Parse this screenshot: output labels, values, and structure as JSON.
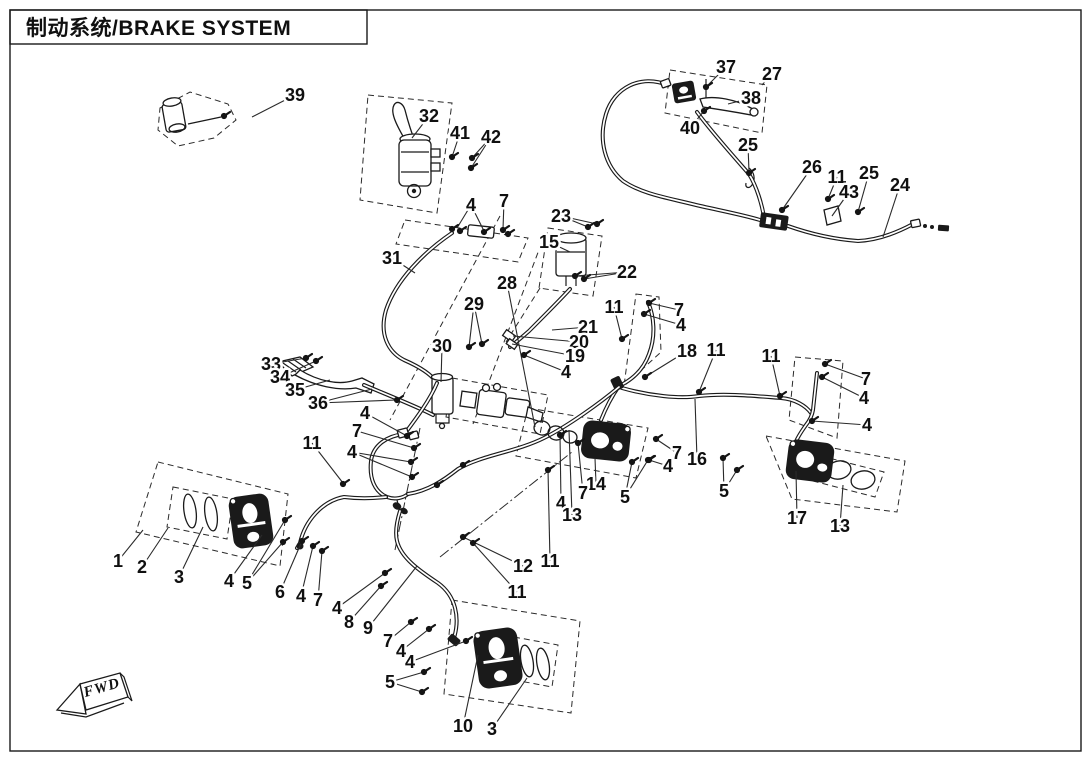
{
  "page": {
    "title": "制动系统/BRAKE SYSTEM",
    "fwd_label": "FWD",
    "colors": {
      "ink": "#1a1a1a",
      "paper": "#ffffff"
    }
  },
  "diagram": {
    "callouts": [
      {
        "n": "39",
        "x": 295,
        "y": 95,
        "t": [
          [
            252,
            117
          ]
        ]
      },
      {
        "n": "37",
        "x": 726,
        "y": 67,
        "t": [
          [
            706,
            87
          ]
        ]
      },
      {
        "n": "27",
        "x": 772,
        "y": 74,
        "t": [
          [
            762,
            85
          ]
        ]
      },
      {
        "n": "38",
        "x": 751,
        "y": 98,
        "t": [
          [
            728,
            104
          ]
        ]
      },
      {
        "n": "40",
        "x": 690,
        "y": 128,
        "t": [
          [
            704,
            111
          ]
        ]
      },
      {
        "n": "25",
        "x": 748,
        "y": 145,
        "t": [
          [
            749,
            172
          ]
        ]
      },
      {
        "n": "26",
        "x": 812,
        "y": 167,
        "t": [
          [
            782,
            210
          ]
        ]
      },
      {
        "n": "11",
        "x": 837,
        "y": 177,
        "t": [
          [
            828,
            199
          ]
        ]
      },
      {
        "n": "43",
        "x": 849,
        "y": 192,
        "t": [
          [
            832,
            216
          ]
        ]
      },
      {
        "n": "25",
        "x": 869,
        "y": 173,
        "t": [
          [
            858,
            212
          ]
        ]
      },
      {
        "n": "24",
        "x": 900,
        "y": 185,
        "t": [
          [
            883,
            237
          ]
        ]
      },
      {
        "n": "32",
        "x": 429,
        "y": 116,
        "t": [
          [
            412,
            138
          ]
        ]
      },
      {
        "n": "41",
        "x": 460,
        "y": 133,
        "t": [
          [
            452,
            157
          ]
        ]
      },
      {
        "n": "42",
        "x": 491,
        "y": 137,
        "t": [
          [
            472,
            158
          ],
          [
            471,
            168
          ]
        ]
      },
      {
        "n": "4",
        "x": 471,
        "y": 205,
        "t": [
          [
            457,
            228
          ],
          [
            484,
            231
          ]
        ]
      },
      {
        "n": "7",
        "x": 504,
        "y": 201,
        "t": [
          [
            503,
            229
          ]
        ]
      },
      {
        "n": "23",
        "x": 561,
        "y": 216,
        "t": [
          [
            588,
            227
          ],
          [
            597,
            224
          ]
        ]
      },
      {
        "n": "15",
        "x": 549,
        "y": 242,
        "t": [
          [
            570,
            252
          ]
        ]
      },
      {
        "n": "22",
        "x": 627,
        "y": 272,
        "t": [
          [
            575,
            276
          ],
          [
            584,
            279
          ]
        ]
      },
      {
        "n": "28",
        "x": 507,
        "y": 283,
        "t": [
          [
            535,
            427
          ]
        ]
      },
      {
        "n": "31",
        "x": 392,
        "y": 258,
        "t": [
          [
            415,
            273
          ]
        ]
      },
      {
        "n": "29",
        "x": 474,
        "y": 304,
        "t": [
          [
            469,
            347
          ],
          [
            482,
            344
          ]
        ]
      },
      {
        "n": "30",
        "x": 442,
        "y": 346,
        "t": [
          [
            441,
            382
          ]
        ]
      },
      {
        "n": "11",
        "x": 614,
        "y": 307,
        "t": [
          [
            622,
            339
          ]
        ]
      },
      {
        "n": "7",
        "x": 679,
        "y": 310,
        "t": [
          [
            649,
            303
          ]
        ]
      },
      {
        "n": "4",
        "x": 681,
        "y": 325,
        "t": [
          [
            644,
            314
          ]
        ]
      },
      {
        "n": "21",
        "x": 588,
        "y": 327,
        "t": [
          [
            552,
            330
          ]
        ]
      },
      {
        "n": "20",
        "x": 579,
        "y": 342,
        "t": [
          [
            513,
            336
          ]
        ]
      },
      {
        "n": "19",
        "x": 575,
        "y": 356,
        "t": [
          [
            512,
            344
          ]
        ]
      },
      {
        "n": "4",
        "x": 566,
        "y": 372,
        "t": [
          [
            524,
            355
          ]
        ]
      },
      {
        "n": "18",
        "x": 687,
        "y": 351,
        "t": [
          [
            645,
            377
          ]
        ]
      },
      {
        "n": "11",
        "x": 716,
        "y": 350,
        "t": [
          [
            699,
            392
          ]
        ]
      },
      {
        "n": "11",
        "x": 771,
        "y": 356,
        "t": [
          [
            780,
            396
          ]
        ]
      },
      {
        "n": "7",
        "x": 866,
        "y": 379,
        "t": [
          [
            825,
            364
          ]
        ]
      },
      {
        "n": "4",
        "x": 864,
        "y": 398,
        "t": [
          [
            822,
            377
          ]
        ]
      },
      {
        "n": "4",
        "x": 867,
        "y": 425,
        "t": [
          [
            812,
            421
          ]
        ]
      },
      {
        "n": "33",
        "x": 271,
        "y": 364,
        "t": [
          [
            306,
            358
          ]
        ]
      },
      {
        "n": "34",
        "x": 280,
        "y": 377,
        "t": [
          [
            316,
            361
          ]
        ]
      },
      {
        "n": "35",
        "x": 295,
        "y": 390,
        "t": [
          [
            330,
            380
          ]
        ]
      },
      {
        "n": "36",
        "x": 318,
        "y": 403,
        "t": [
          [
            372,
            389
          ],
          [
            397,
            400
          ]
        ]
      },
      {
        "n": "4",
        "x": 365,
        "y": 413,
        "t": [
          [
            407,
            436
          ]
        ]
      },
      {
        "n": "7",
        "x": 357,
        "y": 431,
        "t": [
          [
            414,
            448
          ]
        ]
      },
      {
        "n": "4",
        "x": 352,
        "y": 452,
        "t": [
          [
            411,
            462
          ],
          [
            412,
            477
          ]
        ]
      },
      {
        "n": "11",
        "x": 312,
        "y": 443,
        "t": [
          [
            343,
            483
          ]
        ]
      },
      {
        "n": "16",
        "x": 697,
        "y": 459,
        "t": [
          [
            695,
            399
          ]
        ]
      },
      {
        "n": "7",
        "x": 677,
        "y": 453,
        "t": [
          [
            656,
            439
          ]
        ]
      },
      {
        "n": "4",
        "x": 668,
        "y": 466,
        "t": [
          [
            649,
            460
          ]
        ]
      },
      {
        "n": "5",
        "x": 724,
        "y": 491,
        "t": [
          [
            723,
            458
          ],
          [
            737,
            470
          ]
        ]
      },
      {
        "n": "14",
        "x": 596,
        "y": 484,
        "t": [
          [
            595,
            458
          ]
        ]
      },
      {
        "n": "7",
        "x": 583,
        "y": 493,
        "t": [
          [
            578,
            443
          ]
        ]
      },
      {
        "n": "5",
        "x": 625,
        "y": 497,
        "t": [
          [
            632,
            462
          ],
          [
            648,
            460
          ]
        ]
      },
      {
        "n": "4",
        "x": 561,
        "y": 503,
        "t": [
          [
            560,
            435
          ]
        ]
      },
      {
        "n": "13",
        "x": 572,
        "y": 515,
        "t": [
          [
            569,
            430
          ]
        ]
      },
      {
        "n": "17",
        "x": 797,
        "y": 518,
        "t": [
          [
            796,
            471
          ]
        ]
      },
      {
        "n": "13",
        "x": 840,
        "y": 526,
        "t": [
          [
            843,
            485
          ]
        ]
      },
      {
        "n": "1",
        "x": 118,
        "y": 561,
        "t": [
          [
            143,
            530
          ]
        ]
      },
      {
        "n": "2",
        "x": 142,
        "y": 567,
        "t": [
          [
            168,
            528
          ]
        ]
      },
      {
        "n": "3",
        "x": 179,
        "y": 577,
        "t": [
          [
            203,
            527
          ]
        ]
      },
      {
        "n": "4",
        "x": 229,
        "y": 581,
        "t": [
          [
            262,
            535
          ]
        ]
      },
      {
        "n": "5",
        "x": 247,
        "y": 583,
        "t": [
          [
            285,
            520
          ],
          [
            283,
            542
          ]
        ]
      },
      {
        "n": "6",
        "x": 280,
        "y": 592,
        "t": [
          [
            302,
            541
          ]
        ]
      },
      {
        "n": "4",
        "x": 301,
        "y": 596,
        "t": [
          [
            313,
            546
          ]
        ]
      },
      {
        "n": "7",
        "x": 318,
        "y": 600,
        "t": [
          [
            322,
            551
          ]
        ]
      },
      {
        "n": "4",
        "x": 337,
        "y": 608,
        "t": [
          [
            385,
            573
          ]
        ]
      },
      {
        "n": "8",
        "x": 349,
        "y": 622,
        "t": [
          [
            381,
            586
          ]
        ]
      },
      {
        "n": "9",
        "x": 368,
        "y": 628,
        "t": [
          [
            417,
            566
          ]
        ]
      },
      {
        "n": "7",
        "x": 388,
        "y": 641,
        "t": [
          [
            411,
            622
          ]
        ]
      },
      {
        "n": "4",
        "x": 401,
        "y": 651,
        "t": [
          [
            429,
            629
          ]
        ]
      },
      {
        "n": "4",
        "x": 410,
        "y": 662,
        "t": [
          [
            466,
            641
          ]
        ]
      },
      {
        "n": "5",
        "x": 390,
        "y": 682,
        "t": [
          [
            424,
            672
          ],
          [
            422,
            692
          ]
        ]
      },
      {
        "n": "12",
        "x": 523,
        "y": 566,
        "t": [
          [
            463,
            537
          ]
        ]
      },
      {
        "n": "11",
        "x": 550,
        "y": 561,
        "t": [
          [
            548,
            470
          ]
        ]
      },
      {
        "n": "11",
        "x": 517,
        "y": 592,
        "t": [
          [
            473,
            543
          ]
        ]
      },
      {
        "n": "10",
        "x": 463,
        "y": 726,
        "t": [
          [
            478,
            655
          ]
        ]
      },
      {
        "n": "3",
        "x": 492,
        "y": 729,
        "t": [
          [
            527,
            678
          ]
        ]
      }
    ],
    "fasteners": [
      [
        706,
        87
      ],
      [
        704,
        111
      ],
      [
        749,
        173
      ],
      [
        782,
        210
      ],
      [
        828,
        199
      ],
      [
        858,
        212
      ],
      [
        224,
        116
      ],
      [
        452,
        157
      ],
      [
        472,
        158
      ],
      [
        471,
        168
      ],
      [
        452,
        229
      ],
      [
        460,
        231
      ],
      [
        484,
        232
      ],
      [
        503,
        230
      ],
      [
        508,
        234
      ],
      [
        588,
        227
      ],
      [
        597,
        224
      ],
      [
        575,
        276
      ],
      [
        584,
        279
      ],
      [
        469,
        347
      ],
      [
        482,
        344
      ],
      [
        622,
        339
      ],
      [
        649,
        303
      ],
      [
        644,
        314
      ],
      [
        645,
        377
      ],
      [
        699,
        392
      ],
      [
        780,
        396
      ],
      [
        825,
        364
      ],
      [
        822,
        377
      ],
      [
        812,
        421
      ],
      [
        306,
        358
      ],
      [
        316,
        361
      ],
      [
        397,
        400
      ],
      [
        407,
        436
      ],
      [
        414,
        448
      ],
      [
        411,
        462
      ],
      [
        412,
        477
      ],
      [
        343,
        484
      ],
      [
        437,
        485
      ],
      [
        463,
        465
      ],
      [
        656,
        439
      ],
      [
        649,
        460
      ],
      [
        723,
        458
      ],
      [
        737,
        470
      ],
      [
        578,
        443
      ],
      [
        560,
        435
      ],
      [
        632,
        462
      ],
      [
        648,
        460
      ],
      [
        285,
        520
      ],
      [
        283,
        542
      ],
      [
        302,
        541
      ],
      [
        313,
        546
      ],
      [
        322,
        551
      ],
      [
        385,
        573
      ],
      [
        381,
        586
      ],
      [
        411,
        622
      ],
      [
        429,
        629
      ],
      [
        466,
        641
      ],
      [
        424,
        672
      ],
      [
        422,
        692
      ],
      [
        463,
        537
      ],
      [
        473,
        543
      ],
      [
        548,
        470
      ],
      [
        524,
        355
      ]
    ]
  }
}
